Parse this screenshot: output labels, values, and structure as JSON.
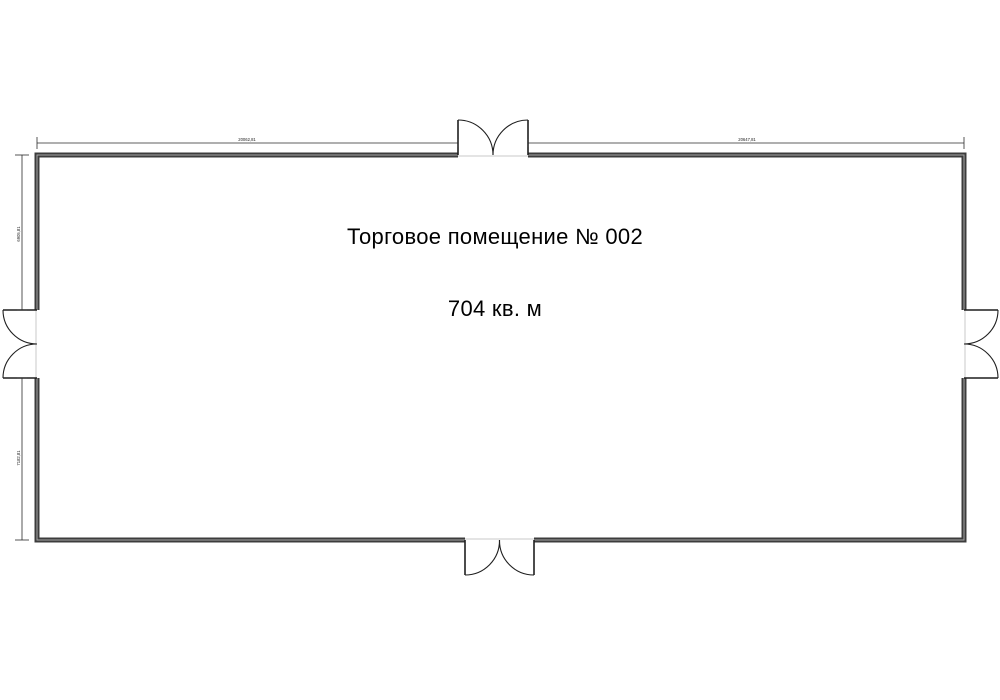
{
  "floor_plan": {
    "room": {
      "title": "Торговое помещение № 002",
      "area_label": "704 кв. м"
    },
    "dimension_labels": {
      "top_left": "20062,81",
      "top_right": "20647,81",
      "left_upper": "6905,81",
      "left_lower": "7182,81"
    },
    "doors": [
      {
        "name": "door-top",
        "type": "double-swing-out"
      },
      {
        "name": "door-bottom",
        "type": "double-swing-out"
      },
      {
        "name": "door-left",
        "type": "double-swing-out"
      },
      {
        "name": "door-right",
        "type": "double-swing-out"
      }
    ],
    "colors": {
      "background": "#ffffff",
      "wall_stroke": "#3c3c3c",
      "wall_core": "#a6a6a6",
      "door_line": "#1f1f1f",
      "dimension_line": "#2a2a2a",
      "threshold": "#c9c9c9",
      "text": "#000000"
    }
  }
}
